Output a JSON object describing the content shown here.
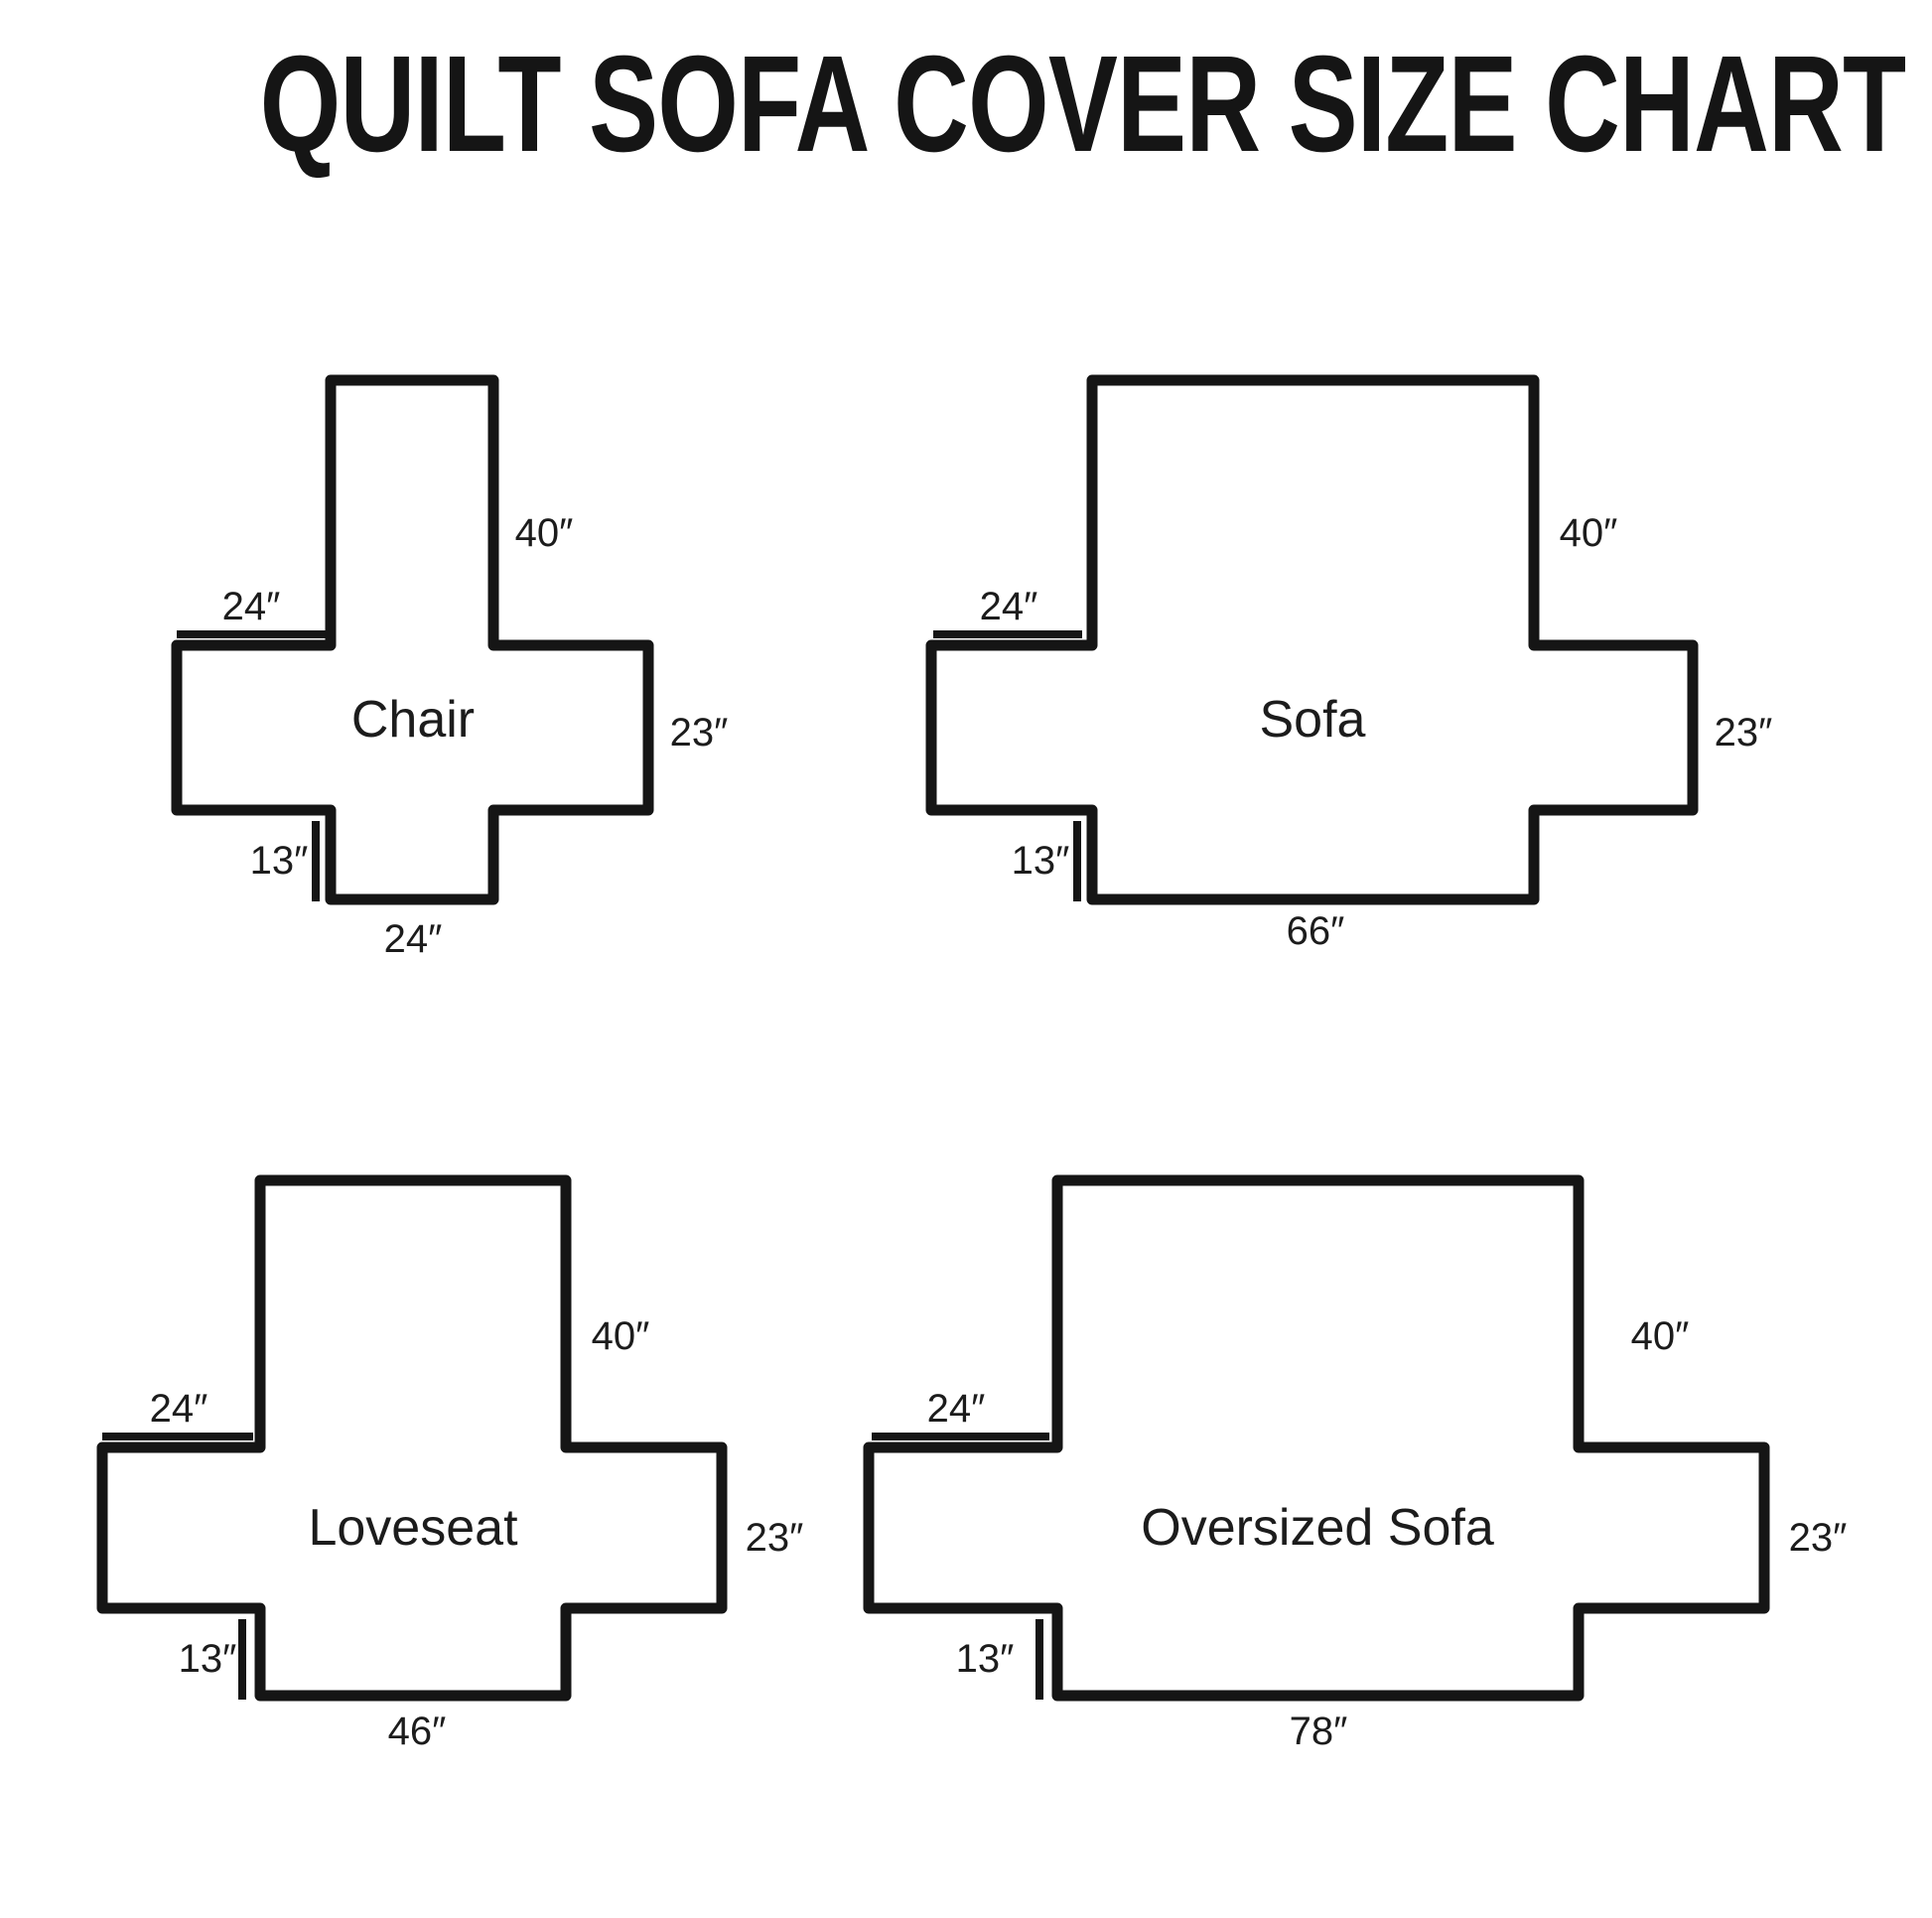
{
  "title": "QUILT SOFA COVER SIZE CHART",
  "colors": {
    "ink": "#151515",
    "background": "#ffffff"
  },
  "diagrams": [
    {
      "name": "Chair",
      "back_height": "40″",
      "arm_top_width": "24″",
      "side_height": "23″",
      "front_drop": "13″",
      "bottom_width": "24″"
    },
    {
      "name": "Sofa",
      "back_height": "40″",
      "arm_top_width": "24″",
      "side_height": "23″",
      "front_drop": "13″",
      "bottom_width": "66″"
    },
    {
      "name": "Loveseat",
      "back_height": "40″",
      "arm_top_width": "24″",
      "side_height": "23″",
      "front_drop": "13″",
      "bottom_width": "46″"
    },
    {
      "name": "Oversized Sofa",
      "back_height": "40″",
      "arm_top_width": "24″",
      "side_height": "23″",
      "front_drop": "13″",
      "bottom_width": "78″"
    }
  ]
}
